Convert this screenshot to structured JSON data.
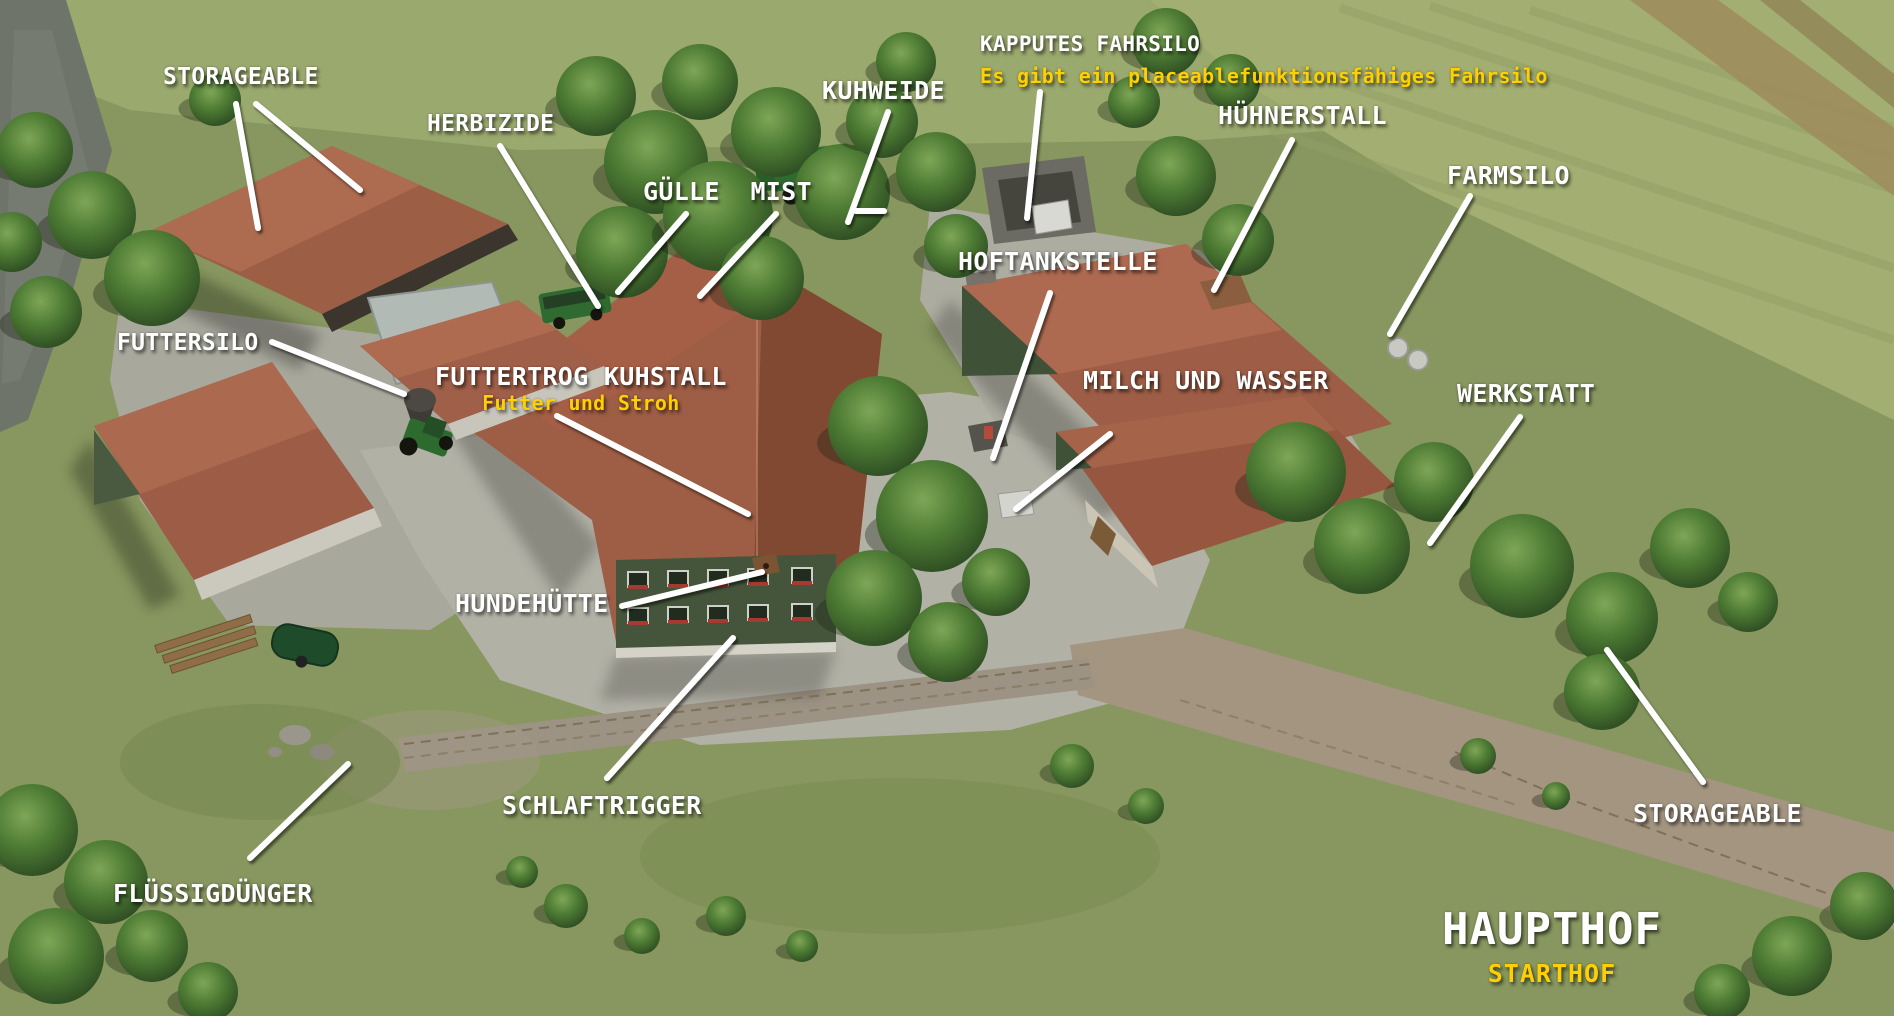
{
  "scene_title": {
    "text": "HAUPTHOF",
    "subtext": "STARTHOF"
  },
  "colors": {
    "label": "#ffffff",
    "highlight": "#ffd000",
    "leader_line": "#ffffff",
    "grass": "#87975f",
    "roof": "#9d5e46",
    "paving": "#b2b1a6"
  },
  "annotations": {
    "labels": [
      {
        "id": "storageable-left",
        "text": "STORAGEABLE",
        "x": 163,
        "y": 65,
        "size": 23
      },
      {
        "id": "herbizide",
        "text": "HERBIZIDE",
        "x": 427,
        "y": 112,
        "size": 23
      },
      {
        "id": "guelle-mist",
        "text": "GÜLLE  MIST",
        "x": 643,
        "y": 178,
        "size": 25
      },
      {
        "id": "kuhweide",
        "text": "KUHWEIDE",
        "x": 822,
        "y": 77,
        "size": 25
      },
      {
        "id": "kapputes-fahrsilo",
        "text": "KAPPUTES FAHRSILO",
        "sub": "Es gibt ein placeablefunktionsfähiges Fahrsilo",
        "x": 980,
        "y": 29,
        "size": 21,
        "subSize": 20,
        "align": "left",
        "lh": 1.5
      },
      {
        "id": "huehnerstall",
        "text": "HÜHNERSTALL",
        "x": 1218,
        "y": 102,
        "size": 25
      },
      {
        "id": "farmsilo",
        "text": "FARMSILO",
        "x": 1447,
        "y": 162,
        "size": 25
      },
      {
        "id": "futtersilo",
        "text": "FUTTERSILO",
        "x": 117,
        "y": 331,
        "size": 23
      },
      {
        "id": "futtertrog-kuhstall",
        "text": "FUTTERTROG KUHSTALL",
        "sub": "Futter und Stroh",
        "x": 435,
        "y": 363,
        "size": 25,
        "subSize": 20,
        "align": "center",
        "lh": 1.15
      },
      {
        "id": "hoftankstelle",
        "text": "HOFTANKSTELLE",
        "x": 958,
        "y": 248,
        "size": 25
      },
      {
        "id": "milch-und-wasser",
        "text": "MILCH UND WASSER",
        "x": 1083,
        "y": 367,
        "size": 25
      },
      {
        "id": "werkstatt",
        "text": "WERKSTATT",
        "x": 1457,
        "y": 380,
        "size": 25
      },
      {
        "id": "hundehuette",
        "text": "HUNDEHÜTTE",
        "x": 455,
        "y": 590,
        "size": 25
      },
      {
        "id": "schlaftrigger",
        "text": "SCHLAFTRIGGER",
        "x": 502,
        "y": 792,
        "size": 25
      },
      {
        "id": "fluessigduenger",
        "text": "FLÜSSIGDÜNGER",
        "x": 113,
        "y": 880,
        "size": 25
      },
      {
        "id": "storageable-right",
        "text": "STORAGEABLE",
        "x": 1633,
        "y": 800,
        "size": 25
      },
      {
        "id": "haupthof",
        "text": "HAUPTHOF",
        "sub": "STARTHOF",
        "x": 1442,
        "y": 901,
        "size": 44,
        "subSize": 25,
        "align": "center",
        "lh": 1.3,
        "ls": 1
      }
    ],
    "lines": [
      {
        "id": "storageable-left-a",
        "x1": 236,
        "y1": 104,
        "x2": 258,
        "y2": 228
      },
      {
        "id": "storageable-left-b",
        "x1": 256,
        "y1": 104,
        "x2": 360,
        "y2": 190
      },
      {
        "id": "herbizide",
        "x1": 500,
        "y1": 146,
        "x2": 598,
        "y2": 306
      },
      {
        "id": "guelle",
        "x1": 686,
        "y1": 214,
        "x2": 618,
        "y2": 292
      },
      {
        "id": "mist",
        "x1": 776,
        "y1": 214,
        "x2": 700,
        "y2": 296
      },
      {
        "id": "kuhweide",
        "x1": 888,
        "y1": 112,
        "x2": 848,
        "y2": 222
      },
      {
        "id": "kuhweide-dash",
        "x1": 856,
        "y1": 211,
        "x2": 884,
        "y2": 211
      },
      {
        "id": "kapputes-fahrsilo",
        "x1": 1040,
        "y1": 92,
        "x2": 1027,
        "y2": 218
      },
      {
        "id": "huehnerstall",
        "x1": 1292,
        "y1": 140,
        "x2": 1214,
        "y2": 290
      },
      {
        "id": "farmsilo",
        "x1": 1470,
        "y1": 196,
        "x2": 1390,
        "y2": 334
      },
      {
        "id": "hoftankstelle",
        "x1": 1050,
        "y1": 293,
        "x2": 993,
        "y2": 458
      },
      {
        "id": "futtersilo",
        "x1": 272,
        "y1": 342,
        "x2": 404,
        "y2": 394
      },
      {
        "id": "futtertrog-kuhstall",
        "x1": 557,
        "y1": 416,
        "x2": 748,
        "y2": 514
      },
      {
        "id": "milch-und-wasser",
        "x1": 1110,
        "y1": 434,
        "x2": 1016,
        "y2": 509
      },
      {
        "id": "werkstatt",
        "x1": 1520,
        "y1": 417,
        "x2": 1430,
        "y2": 543
      },
      {
        "id": "hundehuette",
        "x1": 622,
        "y1": 606,
        "x2": 762,
        "y2": 572
      },
      {
        "id": "schlaftrigger",
        "x1": 607,
        "y1": 778,
        "x2": 733,
        "y2": 638
      },
      {
        "id": "fluessigduenger",
        "x1": 250,
        "y1": 858,
        "x2": 348,
        "y2": 764
      },
      {
        "id": "storageable-right",
        "x1": 1607,
        "y1": 650,
        "x2": 1703,
        "y2": 782
      }
    ]
  }
}
